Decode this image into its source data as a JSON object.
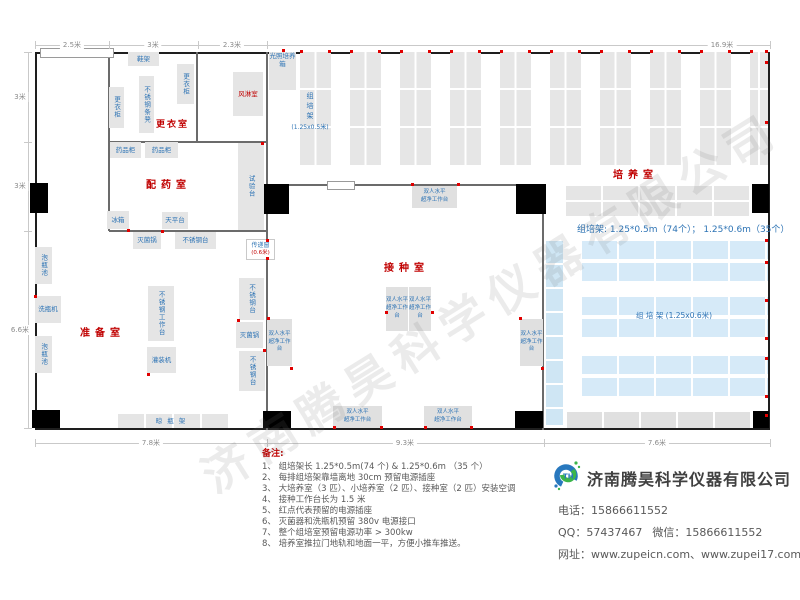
{
  "watermark": "济南腾昊科学仪器有限公司",
  "colors": {
    "room_label": "#c00000",
    "equipment_label": "#2e74b5",
    "wall": "#1e1e1e",
    "equipment_fill": "#e5e5e5",
    "blue_rack_fill": "#d6eaf8",
    "red_dot": "#e00000"
  },
  "dimensions": {
    "top": [
      {
        "label": "2.5米",
        "cx": 72
      },
      {
        "label": "3米",
        "cx": 153
      },
      {
        "label": "2.3米",
        "cx": 232
      },
      {
        "label": "16.9米",
        "cx": 722
      }
    ],
    "top_ticks": [
      35,
      109,
      198,
      267,
      770
    ],
    "left": [
      {
        "label": "3米",
        "cy": 97
      },
      {
        "label": "3米",
        "cy": 186
      },
      {
        "label": "6.6米",
        "cy": 330
      }
    ],
    "left_ticks": [
      52,
      142,
      231,
      428
    ],
    "bottom": [
      {
        "label": "7.8米",
        "cx": 151
      },
      {
        "label": "9.3米",
        "cx": 405
      },
      {
        "label": "7.6米",
        "cx": 657
      }
    ],
    "bottom_ticks": [
      35,
      267,
      544,
      770
    ]
  },
  "plan": {
    "rooms": [
      {
        "label": "更衣室",
        "x": 156,
        "y": 117,
        "fs": 9,
        "ls": 2
      },
      {
        "label": "配药室",
        "x": 146,
        "y": 176,
        "fs": 10,
        "ls": 5
      },
      {
        "label": "准备室",
        "x": 80,
        "y": 324,
        "fs": 10,
        "ls": 5
      },
      {
        "label": "接种室",
        "x": 384,
        "y": 259,
        "fs": 10,
        "ls": 5
      },
      {
        "label": "培养室",
        "x": 613,
        "y": 166,
        "fs": 10,
        "ls": 5
      }
    ],
    "walls": [
      [
        108,
        52,
        2,
        179
      ],
      [
        109,
        141,
        158,
        2
      ],
      [
        196,
        52,
        2,
        90
      ],
      [
        266,
        52,
        2,
        378
      ],
      [
        109,
        230,
        158,
        2
      ],
      [
        267,
        184,
        277,
        2
      ],
      [
        542,
        185,
        2,
        245
      ]
    ],
    "windows": [
      [
        40,
        48,
        72,
        8
      ],
      [
        327,
        181,
        26,
        7
      ]
    ],
    "doors": [
      [
        30,
        183,
        18,
        30
      ],
      [
        262,
        184,
        27,
        30
      ],
      [
        32,
        410,
        28,
        18
      ],
      [
        263,
        411,
        28,
        17
      ],
      [
        516,
        184,
        30,
        30
      ],
      [
        752,
        184,
        17,
        29
      ],
      [
        515,
        411,
        28,
        17
      ],
      [
        753,
        411,
        16,
        17
      ]
    ],
    "blocks": [
      {
        "label": "鞋架",
        "x": 128,
        "y": 52,
        "w": 31,
        "h": 14
      },
      {
        "label": "更衣柜",
        "x": 177,
        "y": 64,
        "w": 17,
        "h": 40,
        "v": 1
      },
      {
        "label": "不锈钢条凳",
        "x": 139,
        "y": 76,
        "w": 15,
        "h": 57,
        "v": 1
      },
      {
        "label": "更衣柜",
        "x": 109,
        "y": 87,
        "w": 15,
        "h": 41,
        "v": 1
      },
      {
        "label": "风淋室",
        "x": 233,
        "y": 72,
        "w": 30,
        "h": 44,
        "red": 1
      },
      {
        "label": "光照培养箱",
        "x": 269,
        "y": 52,
        "w": 27,
        "h": 38,
        "wrap": 1
      },
      {
        "label": "药品柜",
        "x": 110,
        "y": 142,
        "w": 31,
        "h": 16
      },
      {
        "label": "药品柜",
        "x": 145,
        "y": 142,
        "w": 33,
        "h": 16
      },
      {
        "label": "试验台",
        "x": 238,
        "y": 143,
        "w": 26,
        "h": 87,
        "v": 1
      },
      {
        "label": "冰箱",
        "x": 107,
        "y": 211,
        "w": 22,
        "h": 18
      },
      {
        "label": "天平台",
        "x": 162,
        "y": 212,
        "w": 26,
        "h": 17
      },
      {
        "label": "灭菌锅",
        "x": 133,
        "y": 232,
        "w": 28,
        "h": 17
      },
      {
        "label": "不锈钢台",
        "x": 175,
        "y": 232,
        "w": 41,
        "h": 17
      },
      {
        "label": "泡瓶池",
        "x": 35,
        "y": 247,
        "w": 17,
        "h": 37,
        "v": 1
      },
      {
        "label": "洗瓶机",
        "x": 35,
        "y": 296,
        "w": 26,
        "h": 27
      },
      {
        "label": "泡瓶池",
        "x": 35,
        "y": 336,
        "w": 17,
        "h": 37,
        "v": 1
      },
      {
        "label": "不锈钢工作台",
        "x": 148,
        "y": 286,
        "w": 26,
        "h": 55,
        "v": 1
      },
      {
        "label": "灌装机",
        "x": 147,
        "y": 347,
        "w": 29,
        "h": 26
      },
      {
        "label": "不锈钢台",
        "x": 239,
        "y": 278,
        "w": 25,
        "h": 42,
        "v": 1
      },
      {
        "label": "灭菌锅",
        "x": 236,
        "y": 322,
        "w": 27,
        "h": 26
      },
      {
        "label": "不锈钢台",
        "x": 239,
        "y": 351,
        "w": 26,
        "h": 40,
        "v": 1
      },
      {
        "label": "晾瓶架",
        "x": 118,
        "y": 414,
        "w": 110,
        "h": 14,
        "sp": 1,
        "grid": 1
      }
    ],
    "bench_label": "双人水平\n超净工作台",
    "benches": [
      {
        "x": 412,
        "y": 186,
        "w": 45,
        "h": 22
      },
      {
        "x": 386,
        "y": 287,
        "w": 22,
        "h": 44
      },
      {
        "x": 409,
        "y": 287,
        "w": 22,
        "h": 44
      },
      {
        "x": 267,
        "y": 319,
        "w": 25,
        "h": 47
      },
      {
        "x": 520,
        "y": 319,
        "w": 23,
        "h": 47
      },
      {
        "x": 333,
        "y": 406,
        "w": 49,
        "h": 22
      },
      {
        "x": 424,
        "y": 406,
        "w": 48,
        "h": 22
      }
    ],
    "transfer_window": {
      "x": 246,
      "y": 239,
      "w": 27,
      "h": 19,
      "label": "传递窗",
      "size": "(0.6米)"
    },
    "culture": {
      "racks_top": {
        "x0": 300,
        "pitch": 50,
        "w": 31,
        "count": 10,
        "y": 52,
        "h": 113,
        "clip": 768
      },
      "col_label": {
        "x": 288,
        "y": 92,
        "chars": "组培架",
        "size": "(1.25x0.5米)"
      },
      "gray_rack_top": {
        "x": 566,
        "y": 186,
        "w": 184,
        "h": 30
      },
      "gray_rack_bottom": {
        "x": 567,
        "y": 412,
        "w": 185,
        "h": 16
      },
      "blue_strip": {
        "x": 546,
        "y": 241,
        "w": 17,
        "h": 184
      },
      "blue_groups": {
        "x": 582,
        "w": 186,
        "rowH": 18,
        "gap": 4,
        "ys": [
          241,
          297,
          356
        ]
      },
      "rack_note": {
        "x": 577,
        "y": 222,
        "text": "组培架: 1.25*0.5m（74个）； 1.25*0.6m（35个）"
      },
      "mid_label": {
        "x": 636,
        "y": 310,
        "text": "组 培 架 (1.25x0.6米)"
      }
    },
    "red_dots": [
      [
        283,
        50
      ],
      [
        267,
        240
      ],
      [
        267,
        258
      ],
      [
        412,
        184
      ],
      [
        458,
        184
      ],
      [
        386,
        312
      ],
      [
        432,
        312
      ],
      [
        334,
        427
      ],
      [
        381,
        427
      ],
      [
        425,
        427
      ],
      [
        471,
        427
      ],
      [
        520,
        318
      ],
      [
        542,
        368
      ],
      [
        268,
        318
      ],
      [
        291,
        368
      ],
      [
        35,
        296
      ],
      [
        148,
        374
      ],
      [
        238,
        320
      ],
      [
        264,
        350
      ],
      [
        128,
        230
      ],
      [
        162,
        231
      ],
      [
        262,
        143
      ],
      [
        766,
        62
      ],
      [
        766,
        122
      ],
      [
        766,
        240
      ],
      [
        766,
        262
      ],
      [
        766,
        300
      ],
      [
        766,
        338
      ],
      [
        766,
        358
      ],
      [
        766,
        396
      ],
      [
        766,
        415
      ]
    ]
  },
  "notes": {
    "title": "备注:",
    "items": [
      {
        "n": "1、",
        "t": "组培架长 1.25*0.5m(74 个) & 1.25*0.6m （35 个）"
      },
      {
        "n": "2、",
        "t": "每排组培架靠墙离地 30cm 预留电源插座"
      },
      {
        "n": "3、",
        "t": "大培养室（3 匹）、小培养室（2 匹）、接种室（2 匹）安装空调"
      },
      {
        "n": "4、",
        "t": "接种工作台长为 1.5 米"
      },
      {
        "n": "5、",
        "t": "红点代表预留的电源插座"
      },
      {
        "n": "6、",
        "t": "灭菌器和洗瓶机预留 380v 电源接口"
      },
      {
        "n": "7、",
        "t": "整个组培室预留电源功率 > 300kw"
      },
      {
        "n": "8、",
        "t": "培养室推拉门地轨和地面一平，方便小推车推送。"
      }
    ]
  },
  "contact": {
    "company": "济南腾昊科学仪器有限公司",
    "logo_text": "TH",
    "rows": [
      [
        {
          "l": "电话：",
          "v": "15866611552"
        }
      ],
      [
        {
          "l": "QQ：",
          "v": "57437467"
        },
        {
          "l": "微信：",
          "v": "15866611552"
        }
      ],
      [
        {
          "l": "网址：",
          "v": "www.zupeicn.com、www.zupei17.com"
        }
      ]
    ]
  }
}
